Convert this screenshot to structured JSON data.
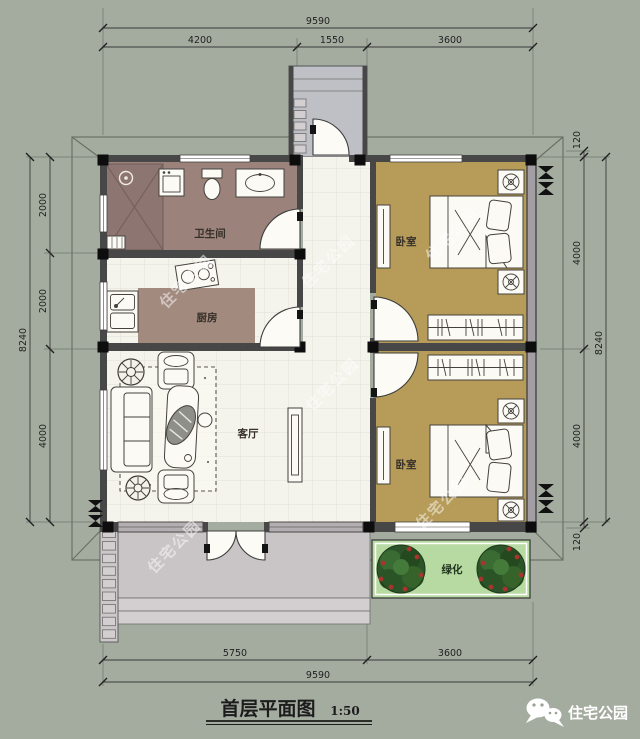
{
  "title": {
    "text": "首层平面图",
    "scale": "1:50"
  },
  "brand": {
    "logo_text": "住宅公园"
  },
  "watermark": {
    "text": "住宅公园"
  },
  "rooms": {
    "bathroom": {
      "label": "卫生间"
    },
    "kitchen": {
      "label": "厨房"
    },
    "living": {
      "label": "客厅"
    },
    "bedroom_top": {
      "label": "卧室"
    },
    "bedroom_bottom": {
      "label": "卧室"
    },
    "green": {
      "label": "绿化"
    }
  },
  "dimensions": {
    "top": {
      "total": "9590",
      "segments": [
        "4200",
        "1550",
        "3600"
      ]
    },
    "bottom": {
      "total": "9590",
      "segments": [
        "5750",
        "3600"
      ]
    },
    "left": {
      "total": "8240",
      "segments": [
        "2000",
        "2000",
        "4000"
      ]
    },
    "right": {
      "total": "8240",
      "segments": [
        "120",
        "4000",
        "4000",
        "120"
      ]
    }
  },
  "colors": {
    "page_bg": "#a4aca0",
    "roof_fill": "#aeb5a8",
    "wall": "#474747",
    "bathroom_floor": "#9b827b",
    "shower_floor": "#8d7571",
    "kitchen_table": "#a28b7e",
    "bedroom_floor": "#b69c58",
    "tile_floor": "#f4f3ec",
    "terrace": "#c9c4c6",
    "porch": "#bfbfc6",
    "green_area": "#b7d9a2",
    "tree": "#2c5429",
    "flower_red": "#a8342e"
  }
}
